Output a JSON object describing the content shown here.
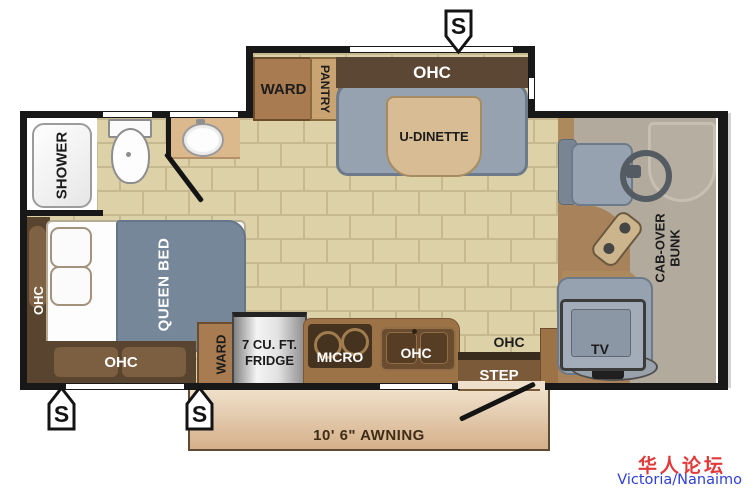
{
  "plan": {
    "speaker_label": "S",
    "bathroom": {
      "shower_label": "SHOWER"
    },
    "bedroom": {
      "side_cabinet_label": "OHC",
      "bed_label": "QUEEN BED",
      "foot_cabinet_label": "OHC",
      "wardrobe_label": "WARD"
    },
    "kitchen": {
      "fridge_label_line1": "7 CU. FT.",
      "fridge_label_line2": "FRIDGE",
      "range_label": "MICRO",
      "sink_cabinet_label": "OHC"
    },
    "entry": {
      "cabinet_label": "OHC",
      "step_label": "STEP"
    },
    "dinette": {
      "wardrobe_label": "WARD",
      "pantry_label": "PANTRY",
      "cabinet_label": "OHC",
      "table_label": "U-DINETTE"
    },
    "cab": {
      "bunk_label_line1": "CAB-OVER",
      "bunk_label_line2": "BUNK",
      "tv_label": "TV"
    },
    "awning_label": "10' 6\" AWNING"
  },
  "watermark": {
    "line1": "华人论坛",
    "line2": "Victoria/Nanaimo"
  }
}
